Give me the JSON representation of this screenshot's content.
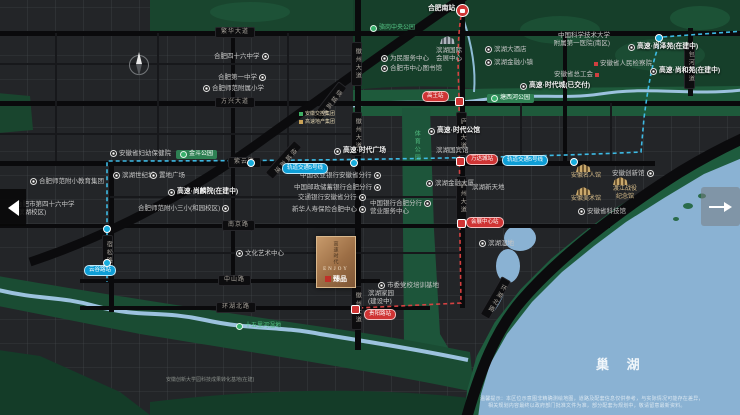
{
  "colors": {
    "land": "#232528",
    "road_black": "#0a0a0c",
    "park_green": "#1e5a3b",
    "park_accent": "#37b06b",
    "water": "#8ab2d3",
    "metro_line5": "#3fc2ee",
    "metro_line1": "#e04343",
    "brand_gold": "#c9a86c",
    "pill_red": "#cf3434",
    "pill_blue": "#0e9ed6"
  },
  "plaque": {
    "cn": "高速时代",
    "en": "ENJOY",
    "sub": "臻品"
  },
  "nav": {
    "prev": "previous-image",
    "next": "next-image"
  },
  "map": {
    "lake_label": "巢 湖",
    "disclaimer": [
      "温馨提示：本区位示意图非精确测绘地图，道路及配套信息仅供参考，与实际情况可能存在差异，",
      "相关规划内容最终以政府部门批准文件为准，部分配套为规划中，敬请留意最新资料。"
    ],
    "labels": [
      {
        "n": "road-fanhua-avenue",
        "c": "road-h",
        "x": 215,
        "y": 27,
        "t": "繁华大道"
      },
      {
        "n": "road-fangxing-avenue",
        "c": "road-h",
        "x": 215,
        "y": 97,
        "t": "方兴大道"
      },
      {
        "n": "road-ziyun-road",
        "c": "road-h",
        "x": 228,
        "y": 157,
        "t": "紫云路"
      },
      {
        "n": "road-nanjing-road",
        "c": "road-h",
        "x": 222,
        "y": 220,
        "t": "南京路"
      },
      {
        "n": "road-zhongshan-road",
        "c": "road-h",
        "x": 218,
        "y": 275,
        "t": "中山路"
      },
      {
        "n": "road-huanhu-north-road",
        "c": "road-h",
        "x": 216,
        "y": 302,
        "t": "环湖北路"
      },
      {
        "n": "road-huizhou-avenue-1",
        "c": "road-v",
        "x": 351,
        "y": 42,
        "t": "徽州大道"
      },
      {
        "n": "road-huizhou-avenue-2",
        "c": "road-v",
        "x": 351,
        "y": 112,
        "t": "徽州大道"
      },
      {
        "n": "road-huizhou-avenue-3",
        "c": "road-v",
        "x": 351,
        "y": 286,
        "t": "徽州大道"
      },
      {
        "n": "road-luzhou-avenue-1",
        "c": "road-v",
        "x": 456,
        "y": 112,
        "t": "庐州大道"
      },
      {
        "n": "road-luzhou-avenue-2",
        "c": "road-v",
        "x": 456,
        "y": 176,
        "t": "庐州大道"
      },
      {
        "n": "road-baohe-avenue",
        "c": "road-v",
        "x": 684,
        "y": 45,
        "t": "包河大道"
      },
      {
        "n": "road-susong-road",
        "c": "road-v",
        "x": 102,
        "y": 235,
        "t": "宿松路"
      },
      {
        "n": "road-ring-expressway-1",
        "c": "road-v",
        "x": 324,
        "y": 80,
        "t": "绕城高速",
        "rot": 38
      },
      {
        "n": "road-ring-expressway-2",
        "c": "road-v",
        "x": 278,
        "y": 138,
        "t": "绕城高速",
        "rot": 42
      },
      {
        "n": "road-huanhu-diagonal",
        "c": "road-v",
        "x": 490,
        "y": 276,
        "t": "环湖北路",
        "rot": 30
      },
      {
        "n": "metro-line5-badge-1",
        "c": "mblue",
        "x": 282,
        "y": 163,
        "t": "轨道交通5号线"
      },
      {
        "n": "metro-line5-badge-2",
        "c": "mblue",
        "x": 502,
        "y": 155,
        "t": "轨道交通5号线"
      },
      {
        "n": "metro-station-yungulu",
        "c": "mblue",
        "x": 84,
        "y": 265,
        "t": "云谷路站"
      },
      {
        "n": "metro-station-gaowang",
        "c": "mred",
        "x": 422,
        "y": 91,
        "t": "高王站"
      },
      {
        "n": "metro-station-wandacheng",
        "c": "mred",
        "x": 466,
        "y": 154,
        "t": "万达城站"
      },
      {
        "n": "metro-station-huizhanzhongxin",
        "c": "mred",
        "x": 466,
        "y": 217,
        "t": "会展中心站"
      },
      {
        "n": "metro-station-guiyanglu",
        "c": "mred",
        "x": 364,
        "y": 309,
        "t": "贵阳路站"
      },
      {
        "n": "park-luogang-central-park",
        "c": "park-text",
        "x": 370,
        "y": 25,
        "t": "骆岗中央公园",
        "icon": "pdot-l"
      },
      {
        "n": "park-jindou-park",
        "c": "park-pill",
        "x": 176,
        "y": 150,
        "t": "金斗公园",
        "icon": "pdot-l"
      },
      {
        "n": "park-tangxihe-park",
        "c": "park-pill",
        "x": 487,
        "y": 94,
        "t": "塘西河公园",
        "icon": "pdot-l"
      },
      {
        "n": "park-shiwulihe-wetland",
        "c": "park-text",
        "x": 236,
        "y": 323,
        "t": "十五里河湿地",
        "icon": "pdot-l"
      },
      {
        "n": "park-sports-park",
        "c": "park-vert",
        "x": 412,
        "y": 130,
        "t": "体育公园"
      },
      {
        "n": "poi-hefei-no46-middle-school",
        "c": "poi",
        "x": 214,
        "y": 53,
        "t": "合肥四十六中学",
        "icon": "dot-r"
      },
      {
        "n": "poi-hefei-no1-high-school",
        "c": "poi",
        "x": 218,
        "y": 74,
        "t": "合肥第一中学",
        "icon": "dot-r"
      },
      {
        "n": "poi-normal-affiliated-primary",
        "c": "poi",
        "x": 203,
        "y": 85,
        "t": "合肥师范附属小学",
        "icon": "dot-l"
      },
      {
        "n": "poi-hefei-south-station",
        "c": "bold",
        "x": 428,
        "y": 5,
        "t": "合肥南站"
      },
      {
        "n": "poi-service-center",
        "c": "poi",
        "x": 381,
        "y": 55,
        "t": "为民服务中心",
        "icon": "dot-l"
      },
      {
        "n": "poi-city-library",
        "c": "poi",
        "x": 381,
        "y": 65,
        "t": "合肥市中心图书馆",
        "icon": "dot-l"
      },
      {
        "n": "poi-binhu-convention-center",
        "c": "poi2",
        "x": 436,
        "y": 47,
        "t": "滨湖国际|会展中心"
      },
      {
        "n": "poi-binhu-hotel",
        "c": "poi",
        "x": 485,
        "y": 46,
        "t": "滨湖大酒店",
        "icon": "dot-l"
      },
      {
        "n": "poi-finance-town",
        "c": "poi",
        "x": 485,
        "y": 59,
        "t": "滨湖金融小镇",
        "icon": "dot-l"
      },
      {
        "n": "poi-ustc-first-hospital",
        "c": "poi2r",
        "x": 550,
        "y": 32,
        "t": "中国科学技术大学|附属第一医院(南区)"
      },
      {
        "n": "poi-gaosu-shangze-court",
        "c": "bold",
        "x": 628,
        "y": 43,
        "t": "高速·尚泽苑(在建中)",
        "icon": "dot-l"
      },
      {
        "n": "poi-provincial-procuratorate",
        "c": "poi",
        "x": 594,
        "y": 60,
        "t": "安徽省人民检察院",
        "icon": "sq-l"
      },
      {
        "n": "poi-provincial-trade-union",
        "c": "poi",
        "x": 554,
        "y": 71,
        "t": "安徽省总工会",
        "icon": "sq-r"
      },
      {
        "n": "poi-gaosu-shanghe-court",
        "c": "bold",
        "x": 650,
        "y": 67,
        "t": "高速·尚和苑(在建中)",
        "icon": "dot-l"
      },
      {
        "n": "poi-gaosu-times-city",
        "c": "bold",
        "x": 520,
        "y": 82,
        "t": "高速·时代城(已交付)",
        "icon": "dot-l"
      },
      {
        "n": "logo-anhui-jiaokong-group",
        "c": "tinygold",
        "x": 299,
        "y": 111,
        "t": "安徽交控集团",
        "icon": "gsq-l"
      },
      {
        "n": "logo-gaosu-real-estate-group",
        "c": "tinygold",
        "x": 299,
        "y": 119,
        "t": "高速地产集团",
        "icon": "ysq-l"
      },
      {
        "n": "poi-gaosu-times-plaza",
        "c": "bold",
        "x": 334,
        "y": 147,
        "t": "高速·时代广场",
        "icon": "dot-l"
      },
      {
        "n": "poi-gaosu-times-mansion",
        "c": "bold",
        "x": 428,
        "y": 127,
        "t": "高速·时代公馆",
        "icon": "dot-l"
      },
      {
        "n": "poi-state-guest-hotel",
        "c": "poi",
        "x": 436,
        "y": 147,
        "t": "滨湖国宾馆"
      },
      {
        "n": "poi-abc-bank-anhui-branch",
        "c": "poi",
        "x": 300,
        "y": 172,
        "t": "中国农业银行安徽省分行",
        "icon": "dot-r"
      },
      {
        "n": "poi-psbc-bank-hefei-branch",
        "c": "poi",
        "x": 294,
        "y": 184,
        "t": "中国邮政储蓄银行合肥分行",
        "icon": "dot-r"
      },
      {
        "n": "poi-bocom-bank-anhui-branch",
        "c": "poi",
        "x": 298,
        "y": 194,
        "t": "交通银行安徽省分行",
        "icon": "dot-r"
      },
      {
        "n": "poi-xinhua-insurance-center",
        "c": "poi",
        "x": 292,
        "y": 206,
        "t": "新华人寿保险合肥中心",
        "icon": "dot-r"
      },
      {
        "n": "poi-maternity-hospital",
        "c": "poi",
        "x": 110,
        "y": 150,
        "t": "安徽省妇幼保健院",
        "icon": "dot-l"
      },
      {
        "n": "poi-binhu-century-city",
        "c": "poi",
        "x": 113,
        "y": 172,
        "t": "滨湖世纪城",
        "icon": "dot-l"
      },
      {
        "n": "poi-zhidi-plaza",
        "c": "poi",
        "x": 150,
        "y": 172,
        "t": "置地广场",
        "icon": "dot-l"
      },
      {
        "n": "poi-normal-third-primary",
        "c": "poi",
        "x": 138,
        "y": 205,
        "t": "合肥师范附小三小(和园校区)",
        "icon": "dot-r"
      },
      {
        "n": "poi-gaosu-shanglin-court",
        "c": "bold",
        "x": 168,
        "y": 188,
        "t": "高速·尚麟院(在建中)",
        "icon": "dot-l"
      },
      {
        "n": "poi-normal-primary-edu-group",
        "c": "poi",
        "x": 30,
        "y": 178,
        "t": "合肥师范附小教育集团",
        "icon": "dot-l"
      },
      {
        "n": "poi-no46-middle-binhu-campus",
        "c": "poi2",
        "x": 16,
        "y": 201,
        "t": "合肥市第四十六中学|(滨湖校区)"
      },
      {
        "n": "poi-culture-art-center",
        "c": "poi",
        "x": 236,
        "y": 250,
        "t": "文化艺术中心",
        "icon": "dot-l"
      },
      {
        "n": "poi-binhu-home",
        "c": "poi2",
        "x": 368,
        "y": 290,
        "t": "滨湖家园|(建设中)"
      },
      {
        "n": "poi-boc-bank-hefei-branch",
        "c": "poi",
        "x": 370,
        "y": 200,
        "t": "中国银行合肥分行",
        "icon": "dot-r"
      },
      {
        "n": "poi-boc-service-center",
        "c": "poi",
        "x": 370,
        "y": 208,
        "t": "营业服务中心"
      },
      {
        "n": "poi-party-school",
        "c": "poi",
        "x": 378,
        "y": 282,
        "t": "市委党校培训基地",
        "icon": "dot-l"
      },
      {
        "n": "poi-binhu-wetland",
        "c": "poi",
        "x": 479,
        "y": 240,
        "t": "滨湖湿地",
        "icon": "dot-l"
      },
      {
        "n": "poi-binhu-finance-tower",
        "c": "poi",
        "x": 426,
        "y": 180,
        "t": "滨湖金融大厦",
        "icon": "dot-l"
      },
      {
        "n": "poi-binhu-xintiandi",
        "c": "poi",
        "x": 472,
        "y": 184,
        "t": "滨湖新天地"
      },
      {
        "n": "poi-anhui-celebrity-hall",
        "c": "gold",
        "x": 571,
        "y": 173,
        "t": "安徽名人馆"
      },
      {
        "n": "poi-anhui-art-museum",
        "c": "gold",
        "x": 571,
        "y": 196,
        "t": "安徽美术馆"
      },
      {
        "n": "poi-dujiang-campaign-memorial",
        "c": "gold2",
        "x": 608,
        "y": 186,
        "t": "渡江战役|纪念馆"
      },
      {
        "n": "poi-anhui-innovation-hall",
        "c": "poi",
        "x": 612,
        "y": 170,
        "t": "安徽创新馆",
        "icon": "dot-r"
      },
      {
        "n": "poi-anhui-science-museum",
        "c": "poi",
        "x": 578,
        "y": 208,
        "t": "安徽省科技馆",
        "icon": "dot-l"
      },
      {
        "n": "poi-tech-transfer-base",
        "c": "tiny",
        "x": 166,
        "y": 377,
        "t": "安徽创新大学园科技成果转化基地(在建)"
      },
      {
        "n": "lake-title-chaohu",
        "c": "laketitle",
        "x": 596,
        "y": 357,
        "t": "巢 湖"
      }
    ],
    "icons": [
      {
        "n": "metro-station-icon",
        "c": "stb",
        "x": 103,
        "y": 259
      },
      {
        "n": "metro-station-icon",
        "c": "stb",
        "x": 103,
        "y": 225
      },
      {
        "n": "metro-station-icon",
        "c": "stb",
        "x": 247,
        "y": 159
      },
      {
        "n": "metro-station-icon",
        "c": "stb",
        "x": 350,
        "y": 159
      },
      {
        "n": "metro-station-icon",
        "c": "stb",
        "x": 570,
        "y": 158
      },
      {
        "n": "metro-station-icon",
        "c": "stb",
        "x": 655,
        "y": 34
      },
      {
        "n": "rail-station-icon",
        "c": "str",
        "x": 455,
        "y": 97
      },
      {
        "n": "rail-station-icon",
        "c": "str",
        "x": 456,
        "y": 157
      },
      {
        "n": "rail-station-icon",
        "c": "str",
        "x": 457,
        "y": 219
      },
      {
        "n": "rail-station-icon",
        "c": "str",
        "x": 351,
        "y": 305
      },
      {
        "n": "hefei-south-railway-icon",
        "c": "trainico",
        "x": 456,
        "y": 4
      },
      {
        "n": "convention-center-building-icon",
        "c": "bldg grey",
        "x": 440,
        "y": 36
      },
      {
        "n": "celebrity-hall-building-icon",
        "c": "bldg",
        "x": 576,
        "y": 164
      },
      {
        "n": "art-museum-building-icon",
        "c": "bldg",
        "x": 576,
        "y": 187
      },
      {
        "n": "dujiang-memorial-building-icon",
        "c": "bldg",
        "x": 613,
        "y": 177
      }
    ]
  }
}
